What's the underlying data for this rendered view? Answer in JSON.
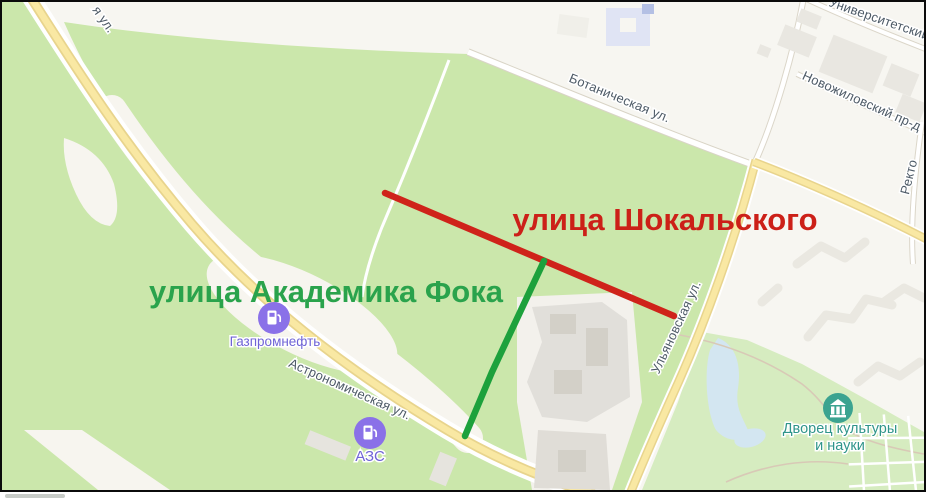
{
  "map": {
    "streets": {
      "top_left_partial": "я ул.",
      "botanicheskaya": "Ботаническая ул.",
      "astronomicheskaya": "Астрономическая ул.",
      "ulyanovskaya": "Ульяновская ул.",
      "universitetsky": "Университетский",
      "novozhilovsky": "Новожиловский пр-д",
      "rektorsky_partial": "Ректо"
    },
    "poi": {
      "gazprom": {
        "label": "Газпромнефть",
        "icon": "fuel-pump-icon",
        "icon_color": "#8a71e8"
      },
      "azs": {
        "label": "АЗС",
        "icon": "fuel-pump-icon",
        "icon_color": "#8a71e8"
      },
      "palace": {
        "label_line1": "Дворец культуры",
        "label_line2": "и науки",
        "icon": "culture-building-icon",
        "icon_color": "#3ba390"
      }
    },
    "colors": {
      "park_green": "#cbe7ab",
      "background_beige": "#f7f6f1",
      "road_yellow": "#f9e8a3",
      "road_yellow_edge": "#e8d48d",
      "water_blue": "#d3e6f1",
      "building_gray": "#e3e1db",
      "street_label_gray": "#4d5a66",
      "frame_border": "#0b0b0b"
    }
  },
  "annotations": {
    "red_street_label": "улица Шокальского",
    "green_street_label": "улица Академика Фока",
    "red_text_color": "#cc2018",
    "red_line_color": "#cf231a",
    "green_text_color": "#2aa34c",
    "green_line_color": "#1da13c"
  }
}
